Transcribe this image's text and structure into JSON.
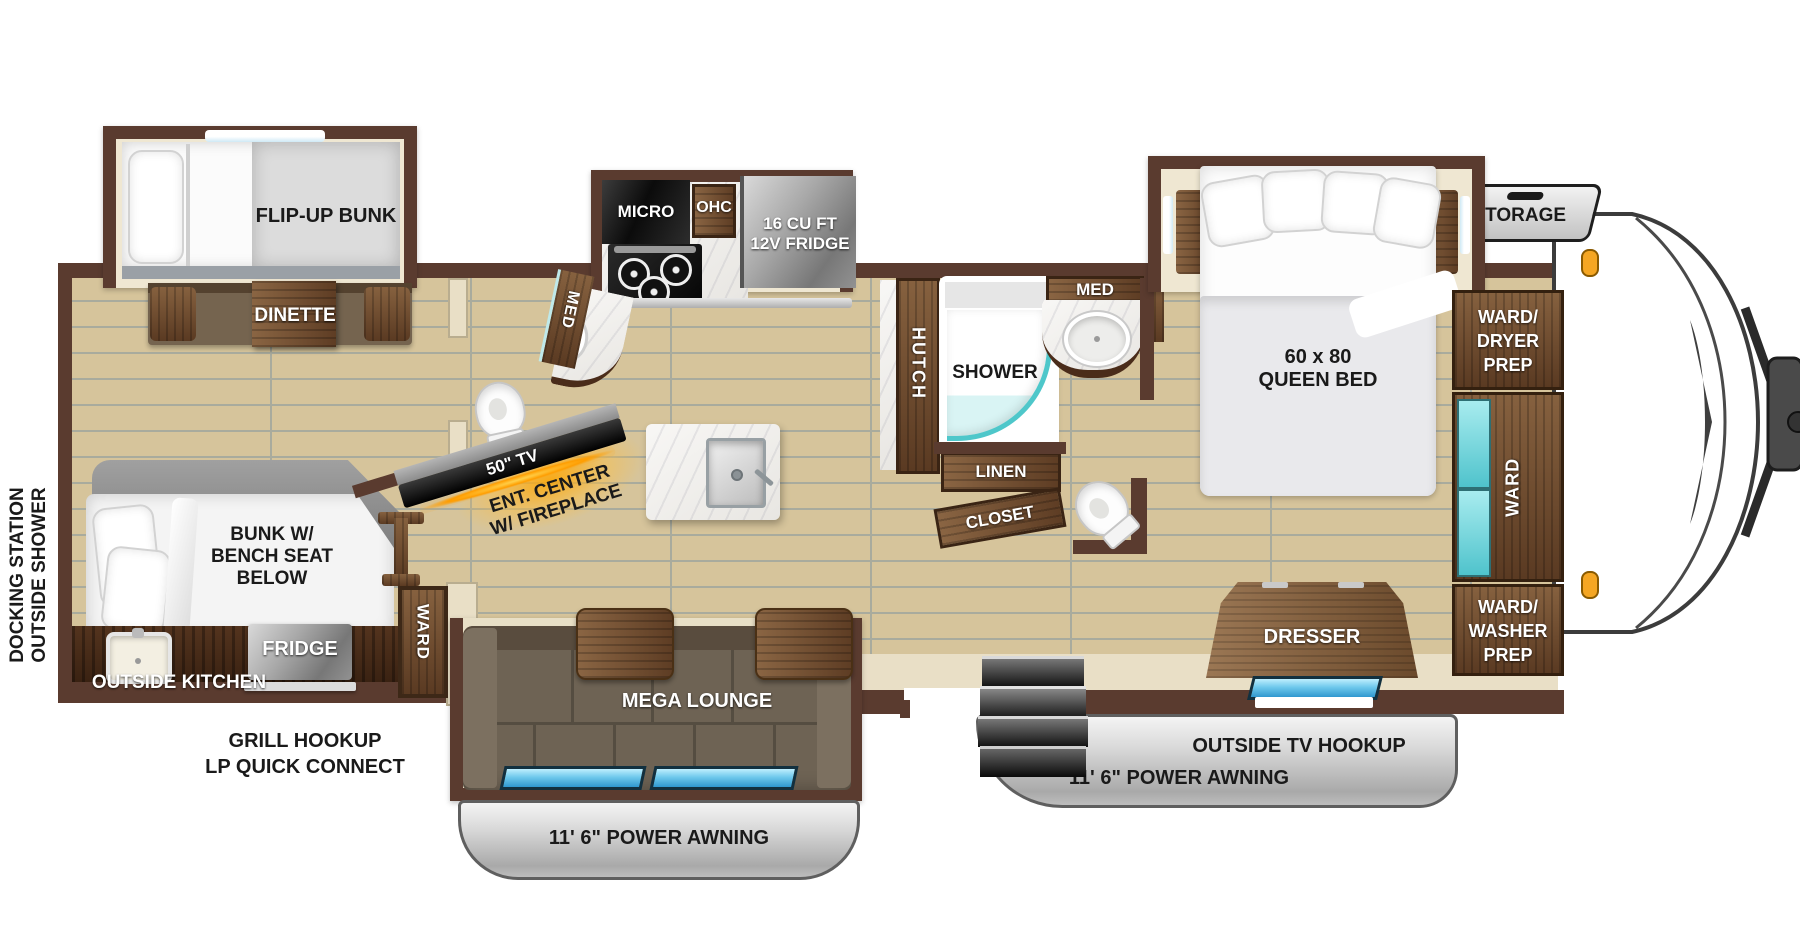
{
  "ext": {
    "dock1": "DOCKING STATION",
    "dock2": "OUTSIDE SHOWER",
    "outside_kitchen": "OUTSIDE KITCHEN",
    "grill1": "GRILL HOOKUP",
    "grill2": "LP QUICK CONNECT",
    "awning_bottom": "11' 6\" POWER AWNING",
    "awning_right": "11' 6\" POWER AWNING",
    "outside_tv": "OUTSIDE TV HOOKUP",
    "storage": "STORAGE"
  },
  "left": {
    "flip_up_bunk": "FLIP-UP BUNK",
    "dinette": "DINETTE",
    "bunk1": "BUNK W/",
    "bunk2": "BENCH SEAT",
    "bunk3": "BELOW",
    "fridge": "FRIDGE",
    "ward": "WARD"
  },
  "liv": {
    "mega": "MEGA LOUNGE",
    "tv": "50\" TV",
    "ent1": "ENT. CENTER",
    "ent2": "W/ FIREPLACE",
    "med": "MED"
  },
  "kit": {
    "micro": "MICRO",
    "ohc": "OHC",
    "fr1": "16 CU FT",
    "fr2": "12V FRIDGE",
    "hutch": "HUTCH"
  },
  "bath": {
    "shower": "SHOWER",
    "med": "MED",
    "linen": "LINEN",
    "closet": "CLOSET"
  },
  "bed": {
    "size": "60 x 80",
    "name": "QUEEN BED",
    "dresser": "DRESSER",
    "wd1": "WARD/",
    "wd2": "DRYER",
    "wd3": "PREP",
    "ward": "WARD",
    "ww1": "WARD/",
    "ww2": "WASHER",
    "ww3": "PREP"
  },
  "colors": {
    "wall": "#5a3b2f",
    "floor": "#d6c49b",
    "teal": "#4ec7ca",
    "window_blue": "#3fa9e0",
    "glow_orange": "#ffa200",
    "awning_gray": "#c9c9c9"
  }
}
